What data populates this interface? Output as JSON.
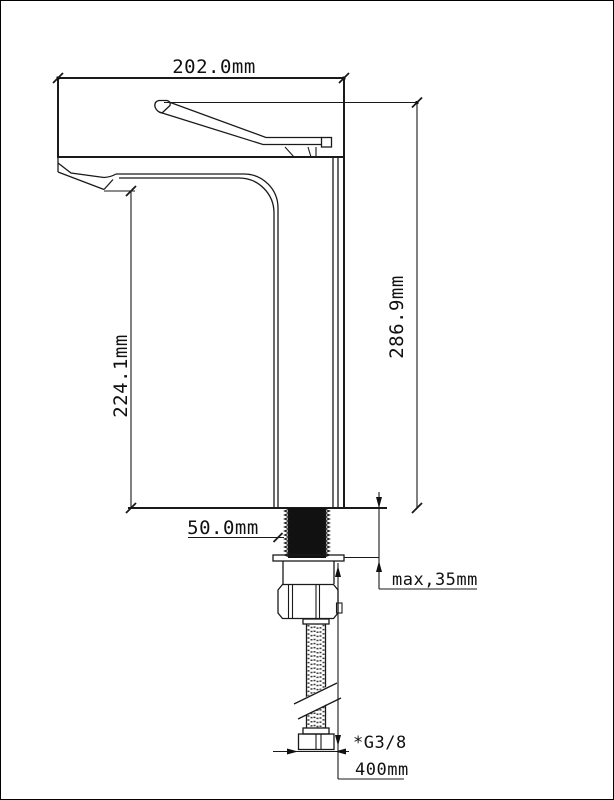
{
  "dimensions": {
    "width_top": "202.0mm",
    "height_total": "286.9mm",
    "height_spout": "224.1mm",
    "shank_length": "50.0mm",
    "max_mount_thickness": "max,35mm",
    "hose_thread": "*G3/8",
    "hose_length": "400mm"
  }
}
